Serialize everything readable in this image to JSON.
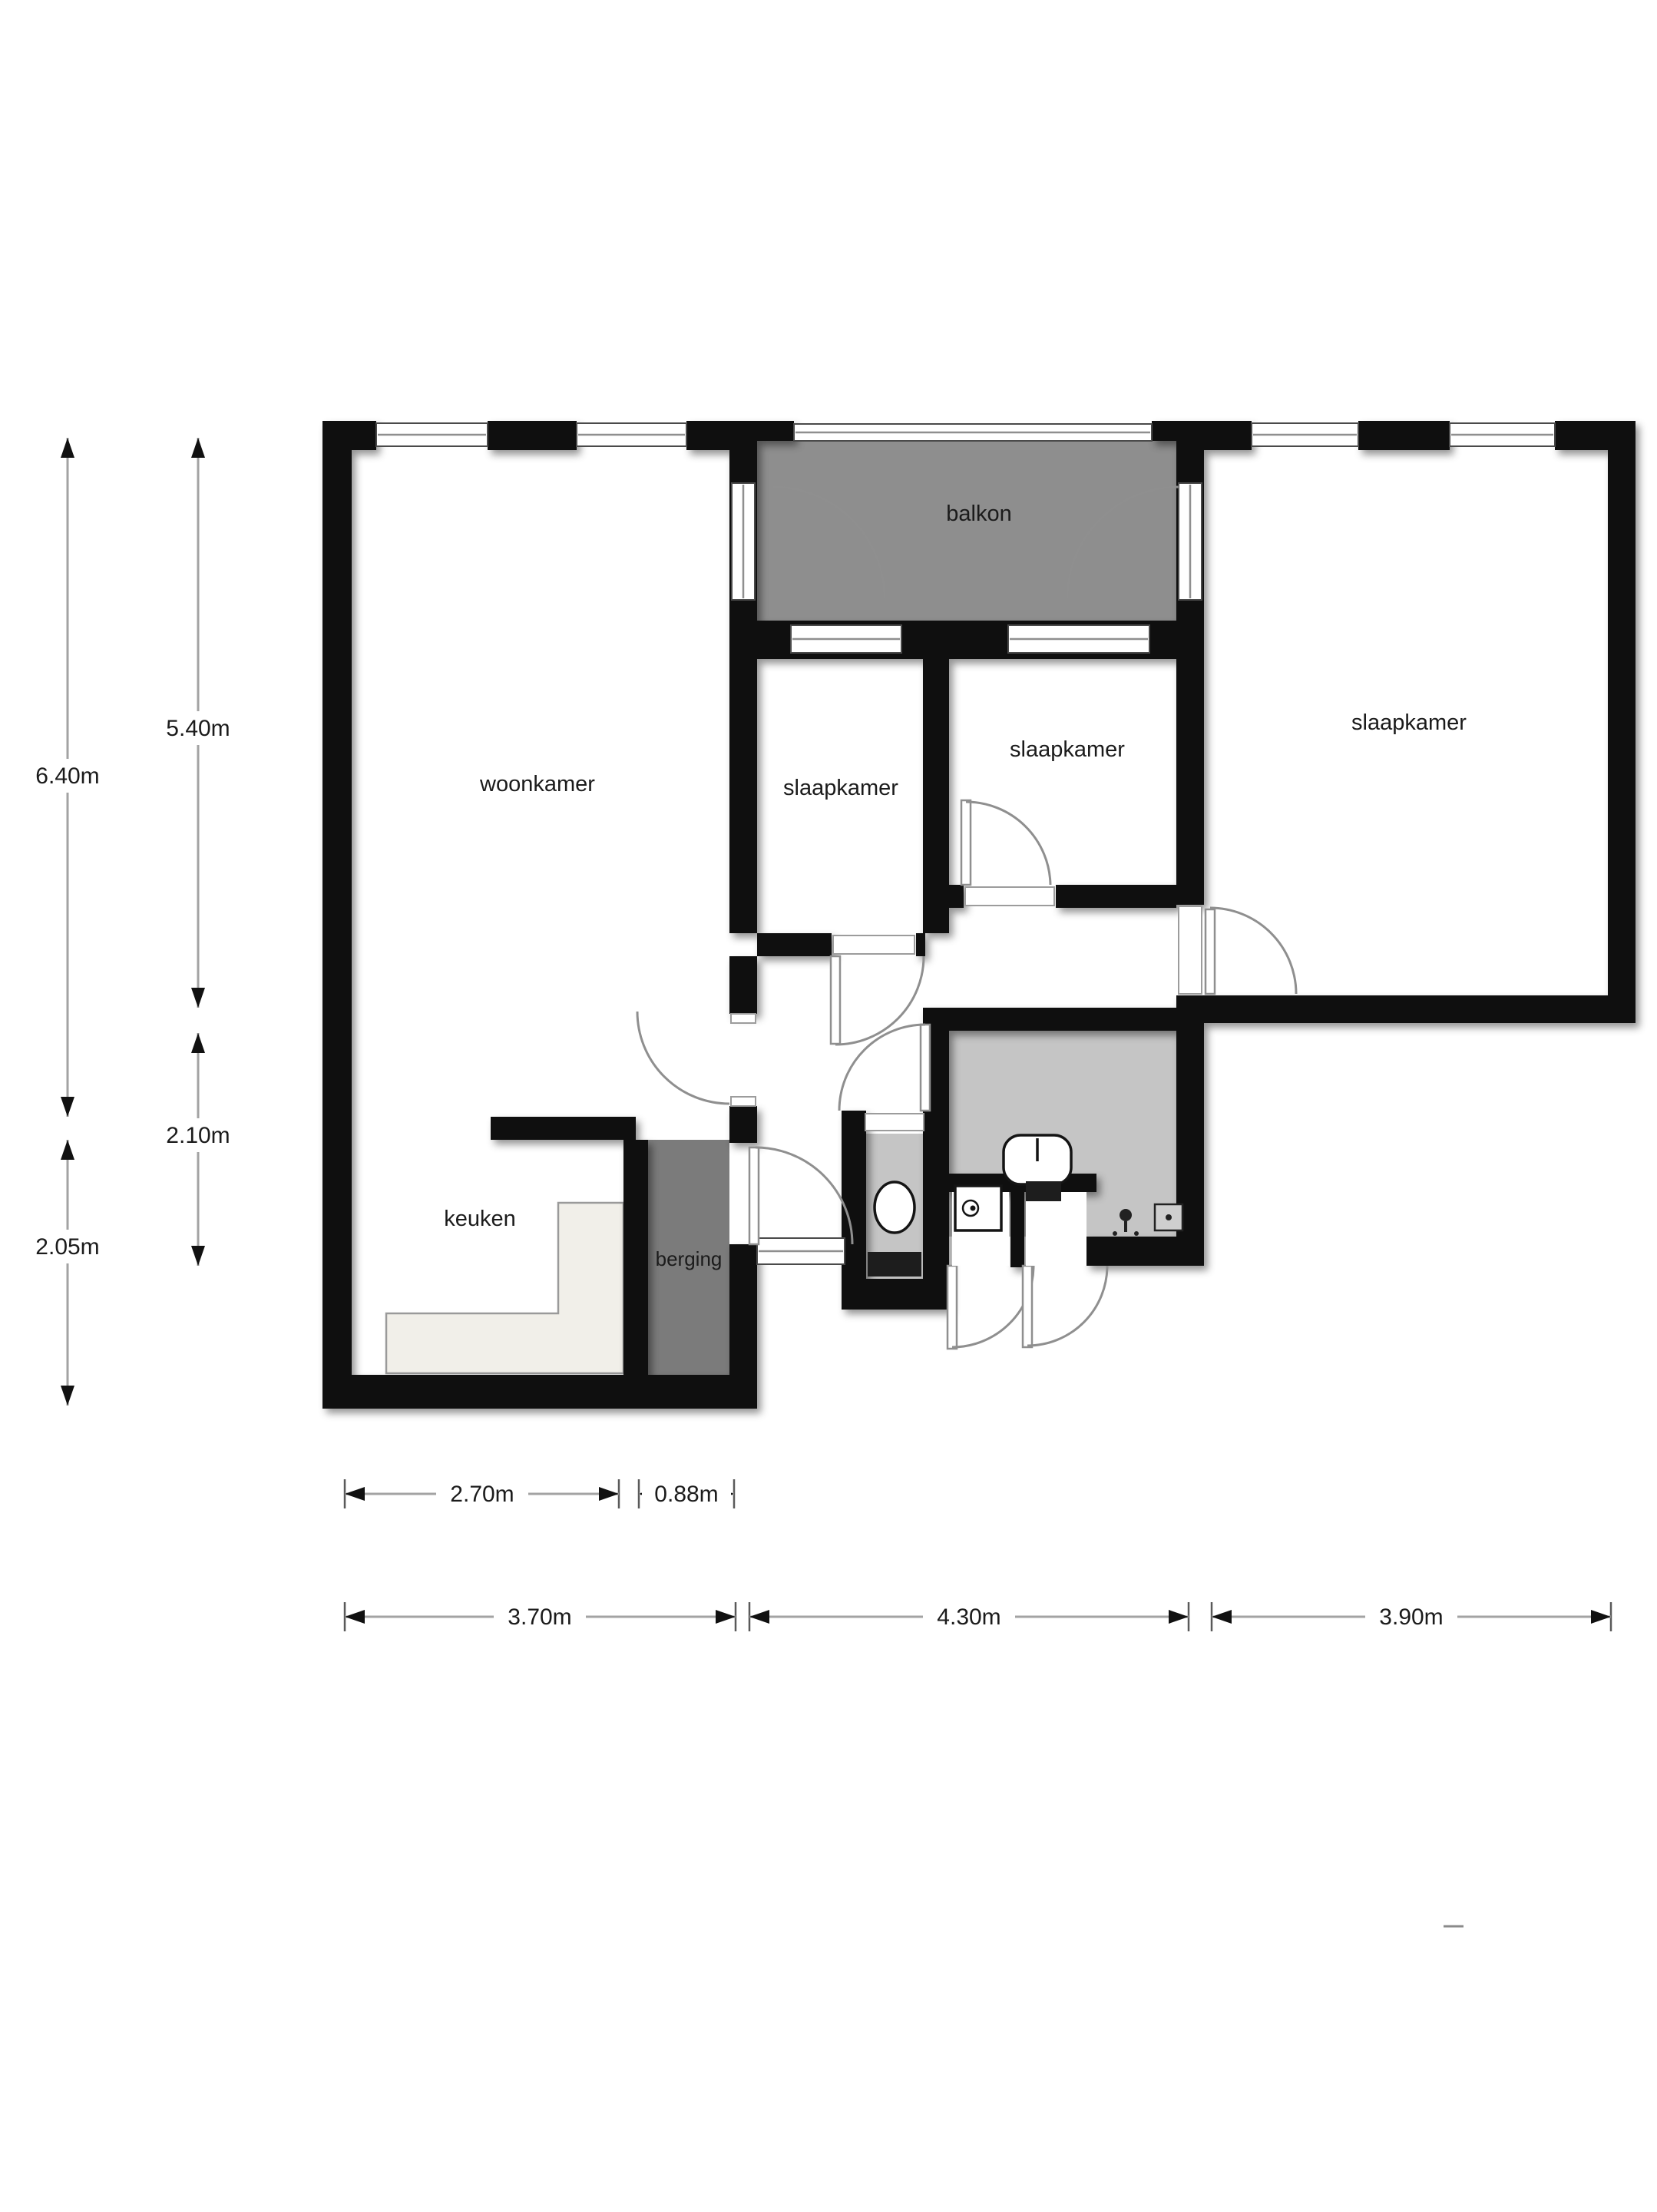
{
  "title": "Plattegrond appartement (floor plan)",
  "colors": {
    "wall": "#0f0f0f",
    "balcony": "#8e8e8e",
    "bath": "#c5c5c5",
    "storage": "#7b7b7b",
    "counter": "#f1efe9",
    "dimline": "#a3a3a3",
    "ink": "#1b1b1b",
    "paper": "#ffffff"
  },
  "rooms": {
    "living": {
      "label": "woonkamer"
    },
    "bedroom_left": {
      "label": "slaapkamer"
    },
    "bedroom_mid": {
      "label": "slaapkamer"
    },
    "bedroom_right": {
      "label": "slaapkamer"
    },
    "balcony": {
      "label": "balkon"
    },
    "kitchen": {
      "label": "keuken"
    },
    "storage": {
      "label": "berging"
    }
  },
  "fixtures": [
    "toilet",
    "sink",
    "washer",
    "shower",
    "drain",
    "kitchen-counter"
  ],
  "dimensions": {
    "left_outer": {
      "upper": "6.40m",
      "lower": "2.05m"
    },
    "left_inner": {
      "upper": "5.40m",
      "lower": "2.10m"
    },
    "bottom_upper": {
      "kitchen": "2.70m",
      "storage": "0.88m"
    },
    "bottom_lower": {
      "left": "3.70m",
      "middle": "4.30m",
      "right": "3.90m"
    }
  }
}
